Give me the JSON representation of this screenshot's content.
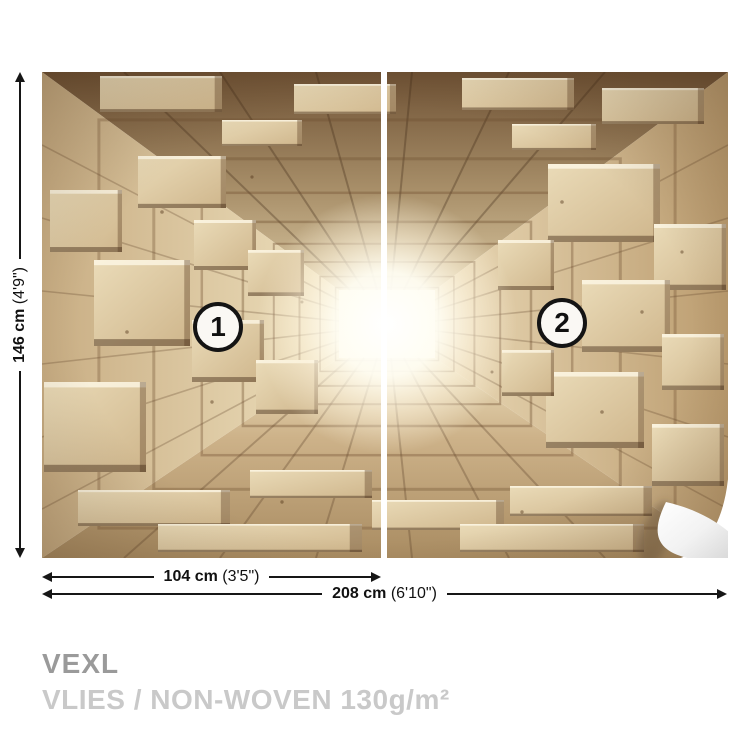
{
  "panels": [
    {
      "label": "1"
    },
    {
      "label": "2"
    }
  ],
  "dimensions": {
    "height": {
      "value": "146 cm",
      "imperial": "(4'9\")"
    },
    "panel_width": {
      "value": "104 cm",
      "imperial": "(3'5\")"
    },
    "total_width": {
      "value": "208 cm",
      "imperial": "(6'10\")"
    }
  },
  "product": {
    "brand": "VEXL",
    "material": "VLIES / NON-WOVEN 130g/m²"
  },
  "colors": {
    "dimension_line": "#161616",
    "brand_text": "#9a9a9a",
    "material_text": "#c9c9c9",
    "badge_border": "#141414",
    "wood_light": "#e8d7b2",
    "wood_mid": "#cdb48c",
    "wood_dark": "#6e5134",
    "glow": "#ffffff"
  }
}
